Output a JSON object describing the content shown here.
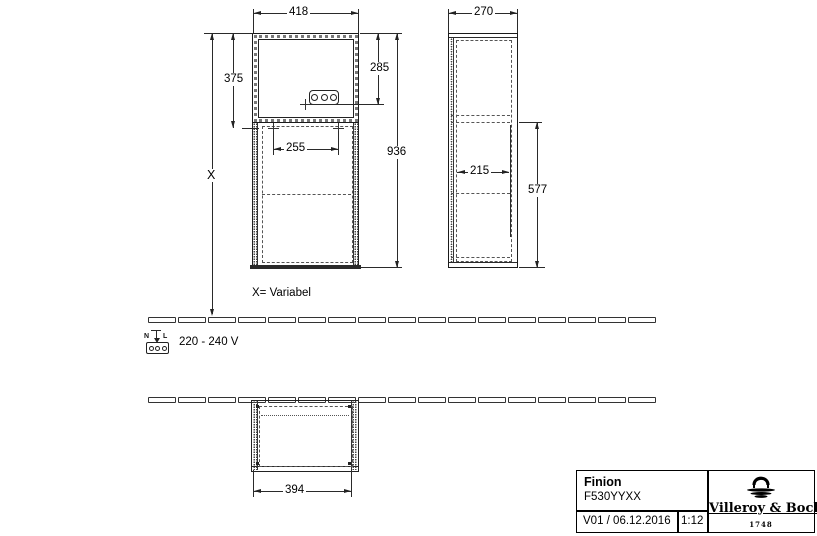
{
  "front_view": {
    "width": "418",
    "upper_section_height": "375",
    "socket_center_from_top": "285",
    "cabinet_height": "936",
    "socket_pair_spacing": "255",
    "mounting_height": "X",
    "variable_note": "X= Variabel"
  },
  "side_view": {
    "depth": "270",
    "inner_depth": "215",
    "lower_section_height": "577"
  },
  "plan_view": {
    "width": "394"
  },
  "power": {
    "voltage": "220 - 240 V",
    "neutral_label": "N",
    "line_label": "L"
  },
  "title_block": {
    "product_name": "Finion",
    "article_number": "F530YYXX",
    "version_date": "V01 / 06.12.2016",
    "scale": "1:12",
    "brand_name": "Villeroy & Boch",
    "brand_founded": "1748"
  }
}
